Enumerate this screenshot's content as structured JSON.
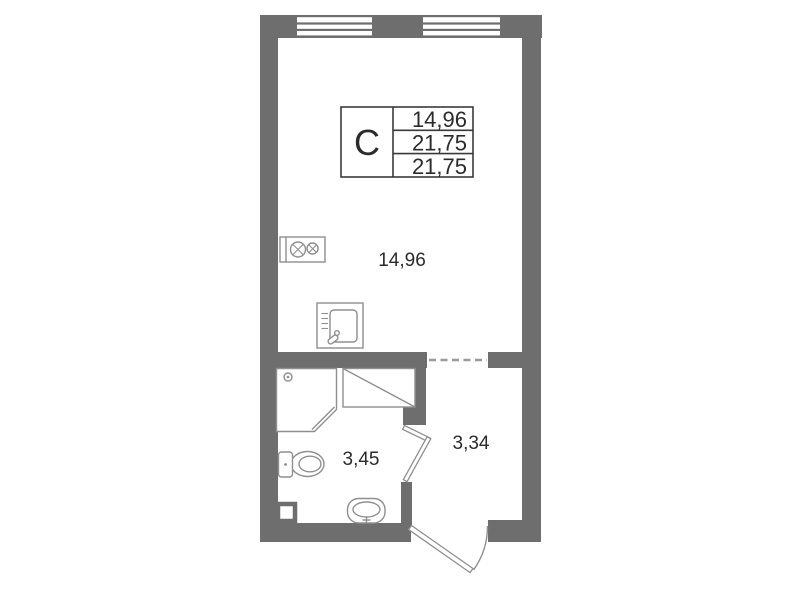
{
  "plan": {
    "title_block": {
      "type_label": "С",
      "rows": [
        "14,96",
        "21,75",
        "21,75"
      ]
    },
    "rooms": {
      "living_area": "14,96",
      "bathroom_area": "3,45",
      "hallway_area": "3,34"
    },
    "colors": {
      "wall": "#6e6e6e",
      "fixture_line": "#8f8f8f",
      "table_line": "#3a3a3a",
      "text": "#2b2b2b",
      "dashed_line": "#9a9a9a",
      "background": "#ffffff"
    },
    "icons": {
      "stove": "stove-icon",
      "kitchen_sink": "kitchen-sink-icon",
      "shower": "shower-cabin-icon",
      "appliance": "appliance-place-icon",
      "toilet": "toilet-icon",
      "washbasin": "washbasin-icon",
      "window": "window-symbol",
      "interior_door": "door-swing-symbol",
      "entrance_door": "entrance-door-swing-symbol",
      "opening": "dashed-opening-symbol"
    }
  }
}
